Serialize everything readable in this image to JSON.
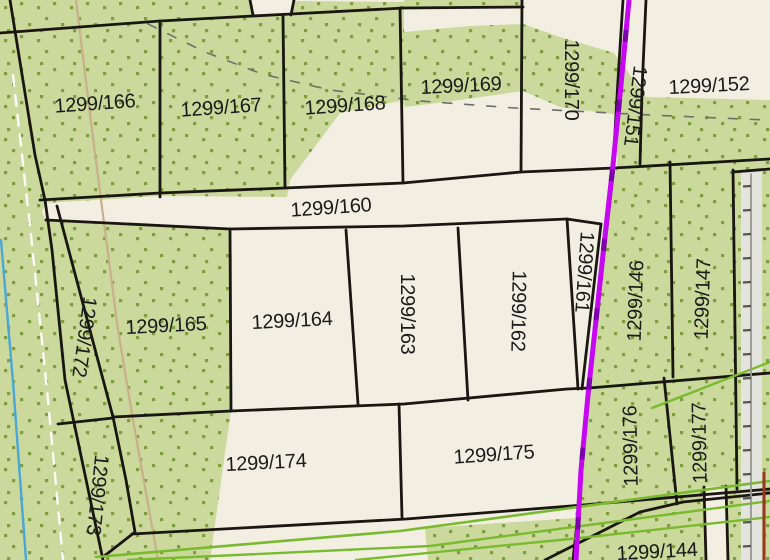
{
  "map": {
    "title": "cadastral-parcel-map",
    "colors": {
      "cream": "#F2EFE2",
      "green": "#CBD99C",
      "dot_green": "#7E9E3F",
      "boundary_black": "#1A1611",
      "label_black": "#1b1b1b",
      "magenta": "#C607F2",
      "magenta_dark_dash": "#7D00AE",
      "bright_green": "#79BA2E",
      "tan": "#C9AF8B",
      "cyan": "#4BA6D9",
      "white_dash": "#FCFCF7",
      "gray_dash": "#6E6E6A",
      "gray_strip": "#E4E4DE",
      "fence_gray": "#97978F",
      "tick_dark": "#55544F",
      "red_edge": "#9C3423"
    },
    "label_font_px": 20,
    "parcel_labels": [
      {
        "id": "1299/166",
        "x": 95,
        "y": 104,
        "rot": -4
      },
      {
        "id": "1299/167",
        "x": 221,
        "y": 108,
        "rot": -4
      },
      {
        "id": "1299/168",
        "x": 345,
        "y": 106,
        "rot": -4
      },
      {
        "id": "1299/169",
        "x": 461,
        "y": 86,
        "rot": -3
      },
      {
        "id": "1299/170",
        "x": 571,
        "y": 80,
        "rot": 90
      },
      {
        "id": "1299/151",
        "x": 635,
        "y": 106,
        "rot": 97
      },
      {
        "id": "1299/152",
        "x": 709,
        "y": 86,
        "rot": -3
      },
      {
        "id": "1299/160",
        "x": 331,
        "y": 208,
        "rot": -4
      },
      {
        "id": "1299/165",
        "x": 166,
        "y": 326,
        "rot": -3
      },
      {
        "id": "1299/164",
        "x": 292,
        "y": 321,
        "rot": -3
      },
      {
        "id": "1299/163",
        "x": 407,
        "y": 314,
        "rot": 90
      },
      {
        "id": "1299/162",
        "x": 518,
        "y": 311,
        "rot": 91
      },
      {
        "id": "1299/161",
        "x": 584,
        "y": 272,
        "rot": 94
      },
      {
        "id": "1299/146",
        "x": 636,
        "y": 301,
        "rot": -88
      },
      {
        "id": "1299/147",
        "x": 703,
        "y": 299,
        "rot": -88
      },
      {
        "id": "1299/172",
        "x": 84,
        "y": 337,
        "rot": 98
      },
      {
        "id": "1299/173",
        "x": 97,
        "y": 495,
        "rot": 96
      },
      {
        "id": "1299/174",
        "x": 266,
        "y": 463,
        "rot": -3
      },
      {
        "id": "1299/175",
        "x": 494,
        "y": 455,
        "rot": -4
      },
      {
        "id": "1299/176",
        "x": 631,
        "y": 446,
        "rot": -91
      },
      {
        "id": "1299/177",
        "x": 700,
        "y": 443,
        "rot": -91
      },
      {
        "id": "1299/144",
        "x": 657,
        "y": 552,
        "rot": -3
      }
    ],
    "green_areas": [
      {
        "name": "green-area-northwest-block",
        "points": "0,0 251,0 254,16 290,15 293,1 404,2 404,32 470,26 523,24 560,37 614,53 646,97 770,100 770,160 617,167 619,115 560,107 523,91 460,100 406,107 400,101 340,113 290,180 287,197 160,196 46,203 42,212 46,220 230,229 232,256 231,411 224,460 215,525 210,560 0,560"
      },
      {
        "name": "green-area-southeast-block",
        "points": "616,169 770,160 770,560 428,560 425,528 575,518 584,440 590,388 598,318 606,242"
      },
      {
        "name": "green-area-top-sliver",
        "points": "404,0 523,0 523,8 404,9"
      }
    ],
    "surface_overlays": [
      {
        "name": "road-strip-east",
        "points": "741,172 762,171 762,560 741,560",
        "fill": "gray_strip"
      },
      {
        "name": "road-sliver-south",
        "points": "704,487 726,486 728,560 706,560",
        "fill": "cream"
      }
    ],
    "boundaries": [
      {
        "name": "boundary-block-west",
        "points": "10,0 35,155 45,200 52,250 65,380 103,560"
      },
      {
        "name": "boundary-row1-north",
        "points": "0,33 160,21 253,16 291,14 404,8 523,7"
      },
      {
        "name": "boundary-notch-left",
        "points": "250,0 253,15"
      },
      {
        "name": "boundary-notch-right",
        "points": "294,0 291,15"
      },
      {
        "name": "boundary-166-167",
        "points": "160,21 160,197"
      },
      {
        "name": "boundary-167-168",
        "points": "283,16 285,188"
      },
      {
        "name": "boundary-168-169",
        "points": "400,8 403,183"
      },
      {
        "name": "boundary-169-170",
        "points": "522,0 521,172"
      },
      {
        "name": "boundary-170-151",
        "points": "623,0 618,80 613,166"
      },
      {
        "name": "boundary-151-152",
        "points": "646,0 642,90 640,164"
      },
      {
        "name": "boundary-row1-south",
        "points": "40,200 160,193 285,188 403,183 521,172 614,168 770,159"
      },
      {
        "name": "boundary-160-south",
        "points": "46,220 230,229 404,226 567,219 601,224"
      },
      {
        "name": "boundary-164-west",
        "points": "230,229 231,411"
      },
      {
        "name": "boundary-164-163",
        "points": "346,230 358,404"
      },
      {
        "name": "boundary-163-162",
        "points": "458,228 468,400"
      },
      {
        "name": "boundary-161-west",
        "points": "567,219 578,389"
      },
      {
        "name": "boundary-161-east",
        "points": "601,224 582,389"
      },
      {
        "name": "boundary-146-west",
        "points": "614,168 605,245 597,320 589,388"
      },
      {
        "name": "boundary-146-147",
        "points": "670,162 673,377"
      },
      {
        "name": "boundary-147-east",
        "points": "733,170 737,489"
      },
      {
        "name": "boundary-right-parcel-north",
        "points": "733,172 770,169"
      },
      {
        "name": "boundary-row2-south",
        "points": "113,417 231,411 404,404 567,389 589,388 770,373"
      },
      {
        "name": "boundary-172-east",
        "points": "57,206 113,417"
      },
      {
        "name": "boundary-172-173",
        "points": "58,424 113,418"
      },
      {
        "name": "boundary-173-east",
        "points": "113,417 126,480 135,532 103,557"
      },
      {
        "name": "boundary-174-175",
        "points": "399,404 402,517"
      },
      {
        "name": "boundary-row3-south",
        "points": "132,534 406,519 583,505 770,489"
      },
      {
        "name": "boundary-176-177",
        "points": "664,378 677,504"
      },
      {
        "name": "boundary-south-strip",
        "points": "545,560 640,512 683,502 770,493"
      },
      {
        "name": "boundary-176-west",
        "points": "583,440 577,523 573,560"
      },
      {
        "name": "boundary-sliver-west",
        "points": "704,487 706,560"
      },
      {
        "name": "boundary-sliver-east",
        "points": "726,486 728,560"
      }
    ],
    "feature_lines": [
      {
        "name": "path-line-tan",
        "color": "tan",
        "width": 2.2,
        "points": "76,0 92,130 103,215 118,330 133,420 158,560"
      },
      {
        "name": "stream-line-cyan",
        "color": "cyan",
        "width": 2.4,
        "points": "1,240 13,382 26,560"
      },
      {
        "name": "edge-line-white-dashed",
        "color": "white_dash",
        "width": 2.4,
        "dash": "11 9",
        "points": "13,75 31,235 47,390 63,560"
      },
      {
        "name": "survey-line-gray-dashed",
        "color": "gray_dash",
        "width": 1.6,
        "dash": "9 13",
        "points": "148,24 205,52 262,74 330,90 420,101 515,108 650,115 766,120"
      },
      {
        "name": "utility-line-green-a",
        "color": "bright_green",
        "width": 2.6,
        "points": "96,557 400,531 770,481"
      },
      {
        "name": "utility-line-green-b",
        "color": "bright_green",
        "width": 2.4,
        "points": "128,560 430,546 770,501"
      },
      {
        "name": "utility-line-green-c",
        "color": "bright_green",
        "width": 2.4,
        "points": "356,560 580,538 770,517"
      },
      {
        "name": "utility-line-green-d",
        "color": "bright_green",
        "width": 2.4,
        "points": "652,408 770,362"
      },
      {
        "name": "fence-line-gray",
        "color": "fence_gray",
        "width": 1.8,
        "points": "751,174 751,560"
      },
      {
        "name": "boundary-line-red",
        "color": "red_edge",
        "width": 3,
        "points": "764,473 764,560"
      }
    ],
    "magenta_line": {
      "name": "pipeline-line-magenta",
      "points": "629,0 621,85 613,165 604,245 596,320 588,395 581,470 576,560",
      "width": 5,
      "dash_overlay": "12 58"
    },
    "fence_ticks": {
      "x1": 743,
      "x2": 751,
      "y_start": 186,
      "y_end": 546,
      "step": 24,
      "width": 2.2
    }
  }
}
